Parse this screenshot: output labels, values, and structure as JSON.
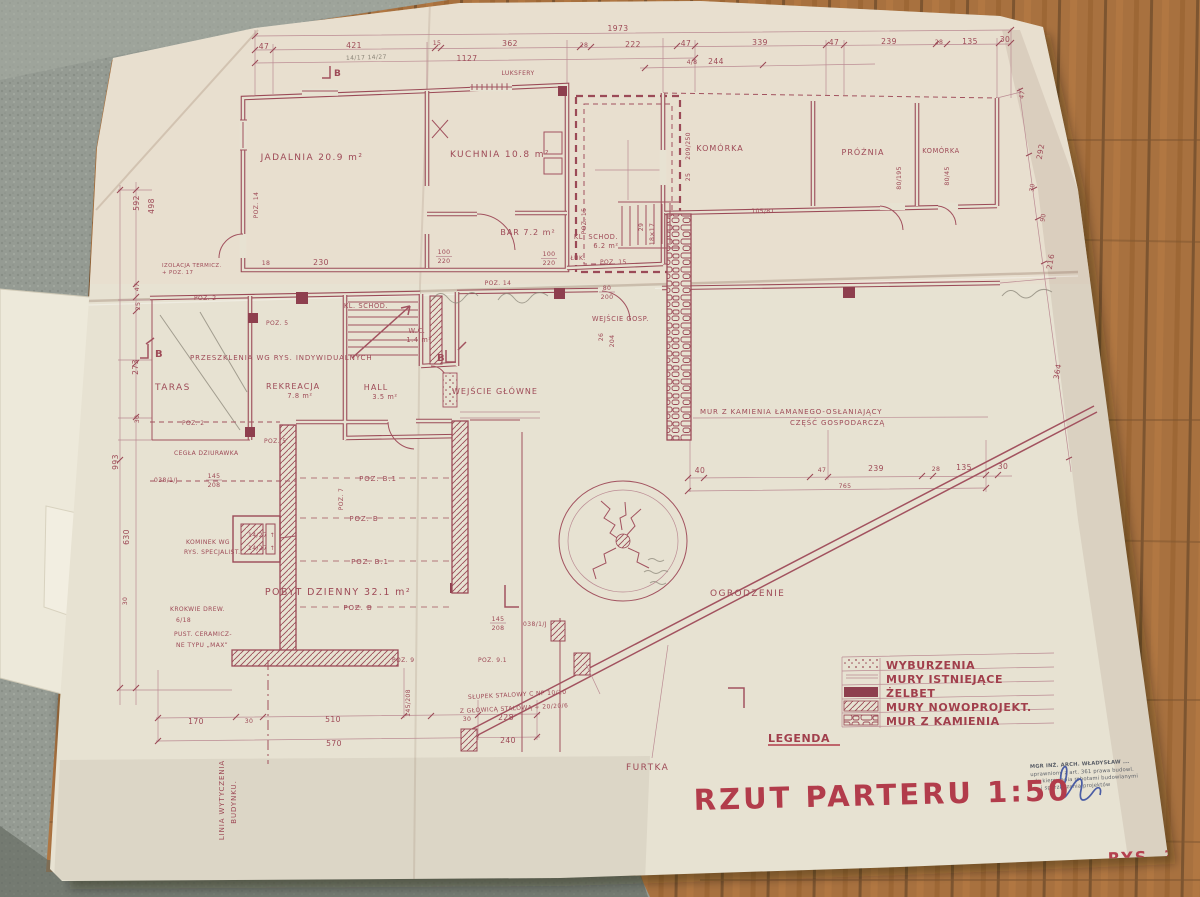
{
  "colors": {
    "paper": "#e7e2d2",
    "ink": "#9b4a57",
    "title_red": "#b23c4b",
    "signature_blue": "#3a4fa0",
    "carpet": "#949a92",
    "wood": "#a06a3a"
  },
  "dims": {
    "overall_top": "1973",
    "top_row": [
      "47",
      "421",
      "15",
      "362",
      "28",
      "222",
      "47",
      "339",
      "47",
      "239",
      "28",
      "135",
      "30"
    ],
    "top_sub": "1127",
    "top_small_a": "4/8",
    "top_small_b": "244",
    "left": [
      "592",
      "498",
      "47",
      "25",
      "273",
      "30",
      "993",
      "630",
      "30"
    ],
    "right": [
      "47",
      "292",
      "30",
      "90",
      "216",
      "364"
    ],
    "mid": [
      "40",
      "47",
      "239",
      "28",
      "135",
      "30"
    ],
    "mid_sub": "765",
    "bottom_row1": [
      "170",
      "30",
      "510",
      "30",
      "228"
    ],
    "bottom_row2": [
      "570",
      "240"
    ],
    "d230": "230",
    "d18": "18",
    "frac_a_num": "100",
    "frac_a_den": "220",
    "frac_b_num": "100",
    "frac_b_den": "220",
    "frac_c_num": "145",
    "frac_c_den": "208",
    "frac_d_num": "145",
    "frac_d_den": "208",
    "frac_e": "145/208",
    "ref_a": "038/1/J",
    "ref_b": "038/1/J",
    "frac_f_num": "80",
    "frac_f_den": "200",
    "d26": "26",
    "d204": "204",
    "d29": "29",
    "d18x17": "18×17",
    "d209": "209/250",
    "d25": "25",
    "d80195": "80/195",
    "d8045": "80/45",
    "d10581": "105/81",
    "arrow_a": "14/27 ↑",
    "arrow_b": "14/27 ↑"
  },
  "rooms": {
    "jadalnia": "JADALNIA 20.9 m²",
    "kuchnia": "KUCHNIA 10.8 m²",
    "komorka1": "KOMÓRKA",
    "proznia": "PRÓŻNIA",
    "komorka2": "KOMÓRKA",
    "bar": "BAR 7.2 m²",
    "kl_schod_gorne": "KL. SCHOD.",
    "kl_schod_m2": "6.2 m²",
    "wc": "W.C.",
    "wc_m2": "1.4 m²",
    "taras": "TARAS",
    "rekreacja": "REKREACJA",
    "rekreacja_m2": "7.8 m²",
    "hall": "HALL",
    "hall_m2": "3.5 m²",
    "kl_schod_dol": "KL. SCHOD.",
    "wejscie_glowne": "WEJŚCIE GŁÓWNE",
    "wejscie_gosp": "WEJŚCIE GOSP.",
    "pobyt": "POBYT DZIENNY 32.1 m²",
    "ogrodzenie": "OGRODZENIE",
    "furtka": "FURTKA"
  },
  "notes": {
    "przeszklenia": "PRZESZKLENIA WG RYS. INDYWIDUALNYCH",
    "mur1": "MUR Z KAMIENIA ŁAMANEGO-OSŁANIAJĄCY",
    "mur2": "CZĘŚĆ GOSPODARCZĄ",
    "kominek1": "KOMINEK WG",
    "kominek2": "RYS. SPECJALIST.",
    "krokwie1": "KROKWIE DREW.",
    "krokwie2": "6/18",
    "pustaki1": "PUST. CERAMICZ-",
    "pustaki2": "NE TYPU „MAX”",
    "cegla": "CEGŁA DZIURAWKA",
    "izolacja1": "IZOLACJA TERMICZ.",
    "izolacja2": "+ POZ. 17",
    "slupek1": "SŁUPEK STALOWY C NP 10/10",
    "slupek2": "Z GŁOWICĄ STALOWĄ + 20/20/6",
    "linia1": "LINIA WYTYCZENIA",
    "linia2": "BUDYNKU.",
    "luksfery": "LUKSFERY",
    "luk": "ŁUK."
  },
  "poz": {
    "p2a": "POZ. 2",
    "p5a": "POZ. 5",
    "p2b": "POZ. 2",
    "p5b": "POZ. 5",
    "p14v": "POZ. 14",
    "p14h": "POZ. 14",
    "p15v": "POZ. 15",
    "p15h": "POZ. 15",
    "p7": "POZ. 7",
    "pB1a": "POZ. B.1",
    "pBa": "POZ. B",
    "pB1b": "POZ. B.1",
    "pBb": "POZ. B",
    "p9": "POZ. 9",
    "p91": "POZ. 9.1"
  },
  "markers": {
    "b1": "B",
    "b2": "B",
    "b3": "B"
  },
  "legend": {
    "label": "LEGENDA",
    "items": [
      "WYBURZENIA",
      "MURY ISTNIEJĄCE",
      "ŻELBET",
      "MURY NOWOPROJEKT.",
      "MUR Z KAMIENIA"
    ]
  },
  "title": {
    "main": "RZUT PARTERU 1:50",
    "sheet": "RYS. 3"
  },
  "stamp": {
    "line1": "MGR INŻ. ARCH. WŁADYSŁAW ...",
    "line2": "uprawniony z art. 361 prawa budowl.",
    "line3": "do kierowania robotami budowlanymi",
    "line4": "i sporządzania projektów"
  },
  "pencil": {
    "note1": "14/17  14/27"
  }
}
